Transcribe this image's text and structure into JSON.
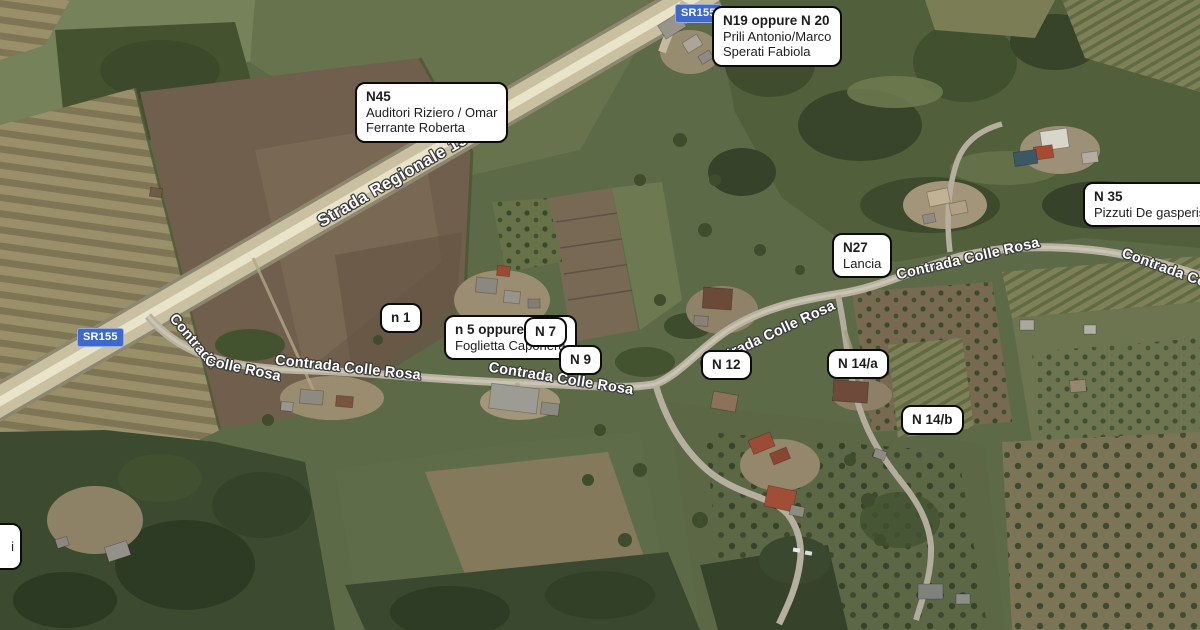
{
  "colors": {
    "marker_bg": "#ffffff",
    "marker_border": "#0b0b0b",
    "shield_bg": "#3e68cc",
    "road_text": "#ffffff"
  },
  "shields": {
    "top": "SR155",
    "left": "SR155"
  },
  "road_labels": {
    "strada_regionale": "Strada Regionale 155",
    "contrada_curved_a": "Contrada",
    "contrada_curved_b": "Colle Rosa",
    "contrada_2": "Contrada Colle Rosa",
    "contrada_3": "Contrada Colle Rosa",
    "contrada_4": "Contrada Colle Rosa",
    "contrada_5": "Contrada Colle Rosa",
    "contrada_edge": "Contrada Colle"
  },
  "markers": {
    "n19": {
      "line1": "N19 oppure N 20",
      "line2": "Prili Antonio/Marco",
      "line3": "Sperati Fabiola"
    },
    "n45": {
      "line1": "N45",
      "line2": "Auditori Riziero / Omar",
      "line3": "Ferrante Roberta"
    },
    "n35": {
      "line1": "N 35",
      "line2": "Pizzuti De gasperis"
    },
    "n27": {
      "line1": "N27",
      "line2": "Lancia"
    },
    "n1": {
      "line1": "n 1"
    },
    "n5": {
      "line1": "n 5 oppure n 21",
      "line2": "Foglietta Caponera"
    },
    "n7": {
      "line1": "N 7"
    },
    "n9": {
      "line1": "N 9"
    },
    "n12": {
      "line1": "N 12"
    },
    "n14a": {
      "line1": "N 14/a"
    },
    "n14b": {
      "line1": "N 14/b"
    },
    "edge_partial": {
      "line1": "i"
    }
  }
}
